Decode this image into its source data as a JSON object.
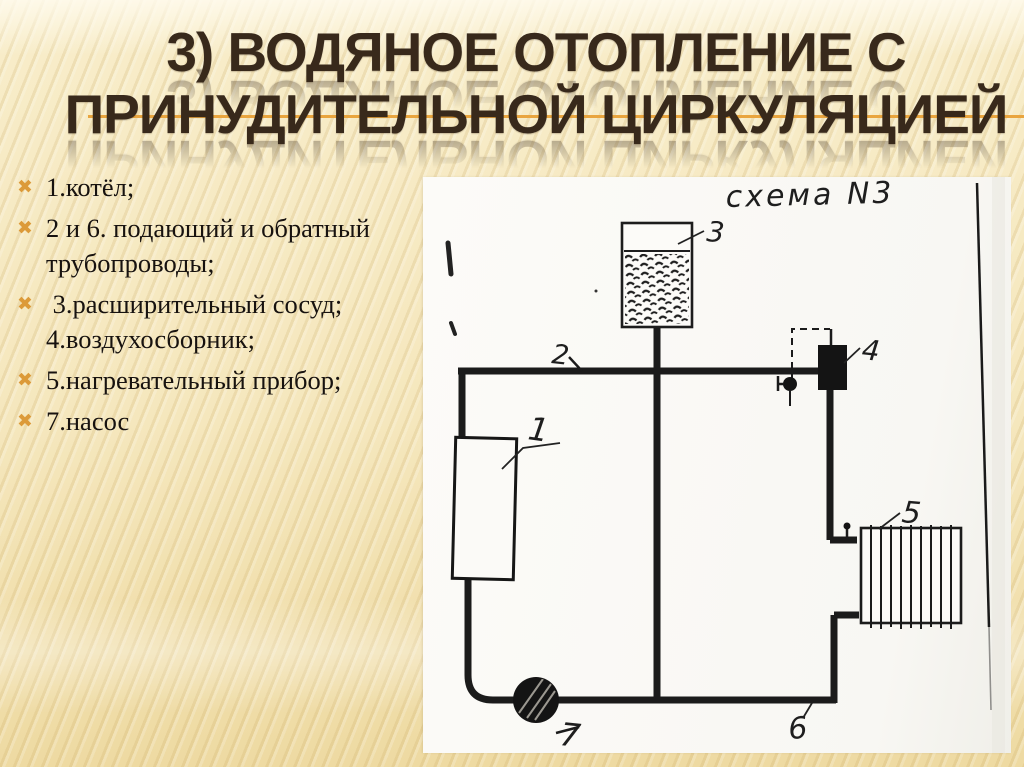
{
  "slide": {
    "title_line1": "3) ВОДЯНОЕ ОТОПЛЕНИЕ С",
    "title_line2": "ПРИНУДИТЕЛЬНОЙ ЦИРКУЛЯЦИЕЙ",
    "title_color": "#38291b",
    "accent_line_color": "#e9a53f",
    "background_color": "#f5e7bd"
  },
  "legend": {
    "bullet_char": "✖",
    "bullet_color": "#dc9a39",
    "items": [
      "1.котёл;",
      "2 и 6. подающий и обратный трубопроводы;",
      " 3.расширительный сосуд; 4.воздухосборник;",
      "5.нагревательный прибор;",
      "7.насос"
    ]
  },
  "diagram": {
    "sheet_title": "схема N3",
    "labels": {
      "boiler": "1",
      "supply_pipe": "2",
      "expansion_vessel": "3",
      "air_collector": "4",
      "radiator": "5",
      "return_pipe": "6",
      "pump": "7"
    }
  }
}
